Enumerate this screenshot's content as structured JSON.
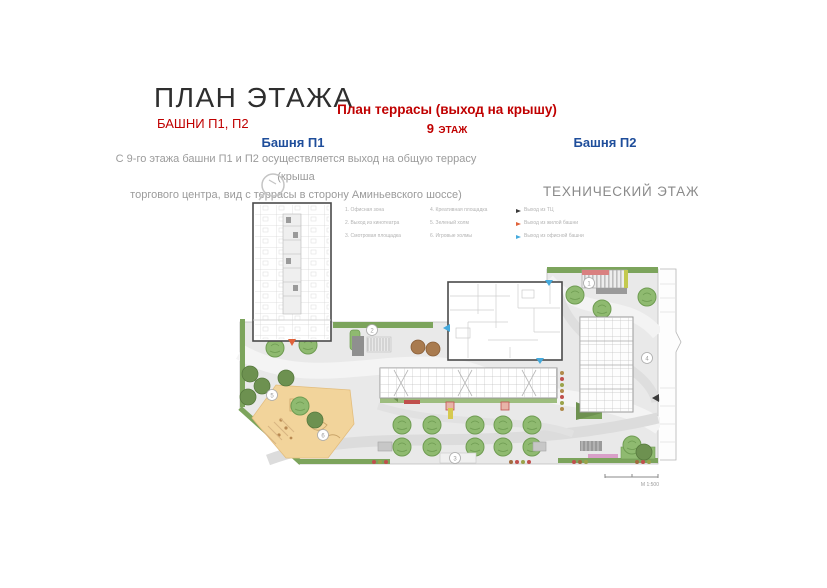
{
  "header": {
    "title": "ПЛАН ЭТАЖА",
    "subtitle": "БАШНИ П1, П2",
    "terrace_title": "План террасы (выход на крышу)",
    "floor_number": "9",
    "floor_word": "ЭТАЖ",
    "tower1_label": "Башня П1",
    "tower2_label": "Башня П2",
    "description_line1": "С 9-го этажа башни П1 и П2 осуществляется выход на общую террасу (крыша",
    "description_line2": "торгового центра, вид с террасы  в сторону Аминьевского шоссе)",
    "tech_floor_label": "ТЕХНИЧЕСКИЙ ЭТАЖ"
  },
  "legend": {
    "items_col1": [
      "1. Офисная зона",
      "2. Выход из кинотеатра",
      "3. Смотровая площадка"
    ],
    "items_col2": [
      "4. Креативная площадка",
      "5. Зеленый холм",
      "6. Игровые холмы"
    ],
    "exits": [
      {
        "label": "Выход из ТЦ",
        "color": "#3a3a3a"
      },
      {
        "label": "Выход из жилой башни",
        "color": "#E0623A"
      },
      {
        "label": "Выход из офисной башни",
        "color": "#45AADD"
      }
    ]
  },
  "plan": {
    "scale_label": "М 1:500",
    "markers": [
      "1",
      "2",
      "3",
      "4",
      "5",
      "6"
    ]
  },
  "colors": {
    "accent_red": "#C00000",
    "accent_blue": "#1F4E9B",
    "gray_text": "#9B9B9B",
    "terrace_base": "#E9E9E9",
    "green": "#7CA45C",
    "dark_green": "#5F8A45",
    "sand": "#F2D49B"
  }
}
